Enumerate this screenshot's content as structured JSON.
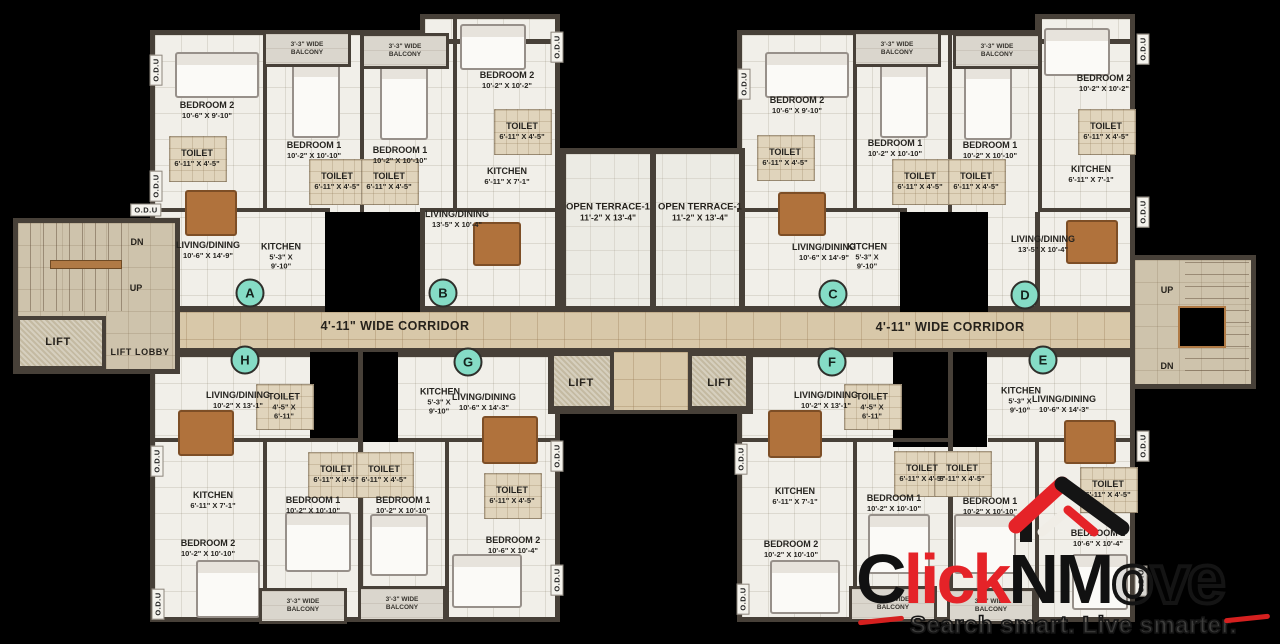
{
  "branding": {
    "logo_c": "C",
    "logo_lick": "lick",
    "logo_nm": "NM",
    "logo_ove": "ove",
    "tagline": "Search smart. Live smarter.",
    "logo_red": "#e52328",
    "logo_black": "#141414"
  },
  "labels": {
    "corridor": "4'-11\" WIDE CORRIDOR",
    "lift": "LIFT",
    "lift_lobby": "LIFT LOBBY",
    "up": "UP",
    "dn": "DN",
    "odu": "O.D.U",
    "terrace_name": "OPEN TERRACE-1",
    "terrace_size": "11'-2\" X 13'-4\"",
    "balcony_line1": "3'-3\" WIDE",
    "balcony_line2": "BALCONY"
  },
  "badge_color": "#85dcc6",
  "unit_badges": [
    {
      "letter": "A",
      "x": 250,
      "y": 293
    },
    {
      "letter": "B",
      "x": 443,
      "y": 293
    },
    {
      "letter": "C",
      "x": 833,
      "y": 294
    },
    {
      "letter": "D",
      "x": 1025,
      "y": 295
    },
    {
      "letter": "H",
      "x": 245,
      "y": 360
    },
    {
      "letter": "G",
      "x": 468,
      "y": 362
    },
    {
      "letter": "F",
      "x": 832,
      "y": 362
    },
    {
      "letter": "E",
      "x": 1043,
      "y": 360
    }
  ],
  "room_labels": [
    {
      "u": "A",
      "n": "BEDROOM 2",
      "s": "10'-6\" X 9'-10\"",
      "x": 207,
      "y": 110
    },
    {
      "u": "A",
      "n": "TOILET",
      "s": "6'-11\" X 4'-5\"",
      "x": 197,
      "y": 158
    },
    {
      "u": "A",
      "n": "LIVING/DINING",
      "s": "10'-6\" X 14'-9\"",
      "x": 208,
      "y": 250
    },
    {
      "u": "A",
      "n": "KITCHEN",
      "s": "5'-3\" X 9'-10\"",
      "x": 281,
      "y": 256,
      "w": 42
    },
    {
      "u": "A",
      "n": "BEDROOM 1",
      "s": "10'-2\" X 10'-10\"",
      "x": 314,
      "y": 150
    },
    {
      "u": "A",
      "n": "TOILET",
      "s": "6'-11\" X 4'-5\"",
      "x": 337,
      "y": 181
    },
    {
      "u": "B",
      "n": "BEDROOM 1",
      "s": "10'-2\" X 10'-10\"",
      "x": 400,
      "y": 155
    },
    {
      "u": "B",
      "n": "TOILET",
      "s": "6'-11\" X 4'-5\"",
      "x": 389,
      "y": 181
    },
    {
      "u": "B",
      "n": "BEDROOM 2",
      "s": "10'-2\" X 10'-2\"",
      "x": 507,
      "y": 80
    },
    {
      "u": "B",
      "n": "TOILET",
      "s": "6'-11\" X 4'-5\"",
      "x": 522,
      "y": 131
    },
    {
      "u": "B",
      "n": "KITCHEN",
      "s": "6'-11\" X 7'-1\"",
      "x": 507,
      "y": 176
    },
    {
      "u": "B",
      "n": "LIVING/DINING",
      "s": "13'-5\" X 10'-4\"",
      "x": 457,
      "y": 219
    },
    {
      "u": "C",
      "n": "BEDROOM 2",
      "s": "10'-6\" X 9'-10\"",
      "x": 797,
      "y": 105
    },
    {
      "u": "C",
      "n": "TOILET",
      "s": "6'-11\" X 4'-5\"",
      "x": 785,
      "y": 157
    },
    {
      "u": "C",
      "n": "LIVING/DINING",
      "s": "10'-6\" X 14'-9\"",
      "x": 824,
      "y": 252
    },
    {
      "u": "C",
      "n": "KITCHEN",
      "s": "5'-3\" X 9'-10\"",
      "x": 867,
      "y": 256,
      "w": 42
    },
    {
      "u": "C",
      "n": "BEDROOM 1",
      "s": "10'-2\" X 10'-10\"",
      "x": 895,
      "y": 148
    },
    {
      "u": "C",
      "n": "TOILET",
      "s": "6'-11\" X 4'-5\"",
      "x": 920,
      "y": 181
    },
    {
      "u": "D",
      "n": "BEDROOM 1",
      "s": "10'-2\" X 10'-10\"",
      "x": 990,
      "y": 150
    },
    {
      "u": "D",
      "n": "TOILET",
      "s": "6'-11\" X 4'-5\"",
      "x": 976,
      "y": 181
    },
    {
      "u": "D",
      "n": "BEDROOM 2",
      "s": "10'-2\" X 10'-2\"",
      "x": 1104,
      "y": 83
    },
    {
      "u": "D",
      "n": "TOILET",
      "s": "6'-11\" X 4'-5\"",
      "x": 1106,
      "y": 131
    },
    {
      "u": "D",
      "n": "KITCHEN",
      "s": "6'-11\" X 7'-1\"",
      "x": 1091,
      "y": 174
    },
    {
      "u": "D",
      "n": "LIVING/DINING",
      "s": "13'-5\" X 10'-4\"",
      "x": 1043,
      "y": 244
    },
    {
      "u": "H",
      "n": "LIVING/DINING",
      "s": "10'-2\" X 13'-1\"",
      "x": 238,
      "y": 400
    },
    {
      "u": "H",
      "n": "TOILET",
      "s": "4'-5\" X 6'-11\"",
      "x": 284,
      "y": 406,
      "w": 38
    },
    {
      "u": "H",
      "n": "KITCHEN",
      "s": "6'-11\" X 7'-1\"",
      "x": 213,
      "y": 500
    },
    {
      "u": "H",
      "n": "BEDROOM 2",
      "s": "10'-2\" X 10'-10\"",
      "x": 208,
      "y": 548
    },
    {
      "u": "H",
      "n": "BEDROOM 1",
      "s": "10'-2\" X 10'-10\"",
      "x": 313,
      "y": 505
    },
    {
      "u": "H",
      "n": "TOILET",
      "s": "6'-11\" X 4'-5\"",
      "x": 336,
      "y": 474
    },
    {
      "u": "G",
      "n": "BEDROOM 1",
      "s": "10'-2\" X 10'-10\"",
      "x": 403,
      "y": 505
    },
    {
      "u": "G",
      "n": "TOILET",
      "s": "6'-11\" X 4'-5\"",
      "x": 384,
      "y": 474
    },
    {
      "u": "G",
      "n": "KITCHEN",
      "s": "5'-3\" X 9'-10\"",
      "x": 439,
      "y": 401,
      "w": 38
    },
    {
      "u": "G",
      "n": "LIVING/DINING",
      "s": "10'-6\" X 14'-3\"",
      "x": 484,
      "y": 402
    },
    {
      "u": "G",
      "n": "TOILET",
      "s": "6'-11\" X 4'-5\"",
      "x": 512,
      "y": 495
    },
    {
      "u": "G",
      "n": "BEDROOM 2",
      "s": "10'-6\" X 10'-4\"",
      "x": 513,
      "y": 545
    },
    {
      "u": "F",
      "n": "LIVING/DINING",
      "s": "10'-2\" X 13'-1\"",
      "x": 826,
      "y": 400
    },
    {
      "u": "F",
      "n": "TOILET",
      "s": "4'-5\" X 6'-11\"",
      "x": 872,
      "y": 406,
      "w": 38
    },
    {
      "u": "F",
      "n": "KITCHEN",
      "s": "6'-11\" X 7'-1\"",
      "x": 795,
      "y": 496
    },
    {
      "u": "F",
      "n": "BEDROOM 2",
      "s": "10'-2\" X 10'-10\"",
      "x": 791,
      "y": 549
    },
    {
      "u": "F",
      "n": "BEDROOM 1",
      "s": "10'-2\" X 10'-10\"",
      "x": 894,
      "y": 503
    },
    {
      "u": "F",
      "n": "TOILET",
      "s": "6'-11\" X 4'-5\"",
      "x": 922,
      "y": 473
    },
    {
      "u": "E",
      "n": "BEDROOM 1",
      "s": "10'-2\" X 10'-10\"",
      "x": 990,
      "y": 506
    },
    {
      "u": "E",
      "n": "TOILET",
      "s": "6'-11\" X 4'-5\"",
      "x": 962,
      "y": 473
    },
    {
      "u": "E",
      "n": "KITCHEN",
      "s": "5'-3\" X 9'-10\"",
      "x": 1020,
      "y": 400,
      "w": 38
    },
    {
      "u": "E",
      "n": "LIVING/DINING",
      "s": "10'-6\" X 14'-3\"",
      "x": 1064,
      "y": 404
    },
    {
      "u": "E",
      "n": "TOILET",
      "s": "6'-11\" X 4'-5\"",
      "x": 1108,
      "y": 489
    },
    {
      "u": "E",
      "n": "BEDROOM 2",
      "s": "10'-6\" X 10'-4\"",
      "x": 1098,
      "y": 538
    }
  ],
  "odu_positions": [
    {
      "x": 156,
      "y": 70,
      "v": 1
    },
    {
      "x": 156,
      "y": 186,
      "v": 1
    },
    {
      "x": 146,
      "y": 210,
      "v": 0
    },
    {
      "x": 157,
      "y": 461,
      "v": 1
    },
    {
      "x": 158,
      "y": 604,
      "v": 1
    },
    {
      "x": 557,
      "y": 47,
      "v": 1
    },
    {
      "x": 744,
      "y": 84,
      "v": 1
    },
    {
      "x": 557,
      "y": 456,
      "v": 1
    },
    {
      "x": 557,
      "y": 580,
      "v": 1
    },
    {
      "x": 741,
      "y": 459,
      "v": 1
    },
    {
      "x": 743,
      "y": 599,
      "v": 1
    },
    {
      "x": 1143,
      "y": 49,
      "v": 1
    },
    {
      "x": 1143,
      "y": 212,
      "v": 1
    },
    {
      "x": 1143,
      "y": 446,
      "v": 1
    },
    {
      "x": 1141,
      "y": 581,
      "v": 1
    }
  ],
  "balconies_top": [
    {
      "x": 263,
      "y": 31
    },
    {
      "x": 361,
      "y": 33
    },
    {
      "x": 853,
      "y": 31
    },
    {
      "x": 953,
      "y": 33
    }
  ],
  "balconies_bottom": [
    {
      "x": 259,
      "y": 588
    },
    {
      "x": 358,
      "y": 586
    },
    {
      "x": 849,
      "y": 586
    },
    {
      "x": 947,
      "y": 588
    }
  ],
  "terrace_positions": [
    {
      "x": 608,
      "y": 212
    },
    {
      "x": 700,
      "y": 212
    }
  ],
  "corridor_positions": [
    {
      "x": 395,
      "y": 326
    },
    {
      "x": 950,
      "y": 327
    }
  ],
  "lift_positions": [
    {
      "x": 58,
      "y": 342
    },
    {
      "x": 581,
      "y": 383
    },
    {
      "x": 720,
      "y": 383
    }
  ],
  "lift_lobby_position": {
    "x": 140,
    "y": 352
  },
  "stair_labels": [
    {
      "t": "DN",
      "x": 137,
      "y": 242
    },
    {
      "t": "UP",
      "x": 136,
      "y": 288
    },
    {
      "t": "UP",
      "x": 1167,
      "y": 290
    },
    {
      "t": "DN",
      "x": 1167,
      "y": 366
    }
  ]
}
